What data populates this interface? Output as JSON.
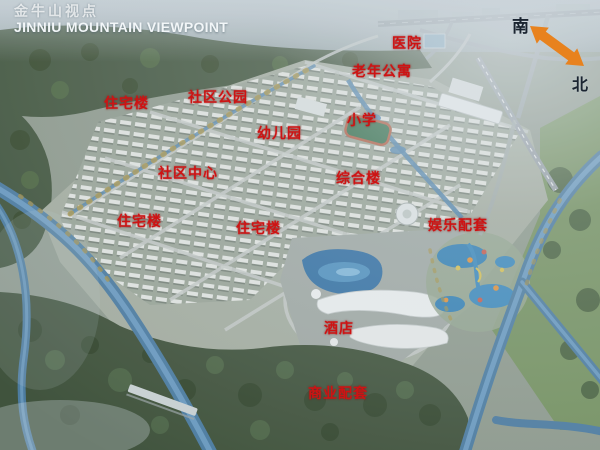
{
  "header": {
    "title_cn": "金牛山视点",
    "title_en": "JINNIU MOUNTAIN VIEWPOINT"
  },
  "compass": {
    "south_label": "南",
    "north_label": "北",
    "arrow_icon": "double-headed-diagonal-arrow"
  },
  "map_labels": [
    {
      "text": "医院"
    },
    {
      "text": "老年公寓"
    },
    {
      "text": "住宅楼"
    },
    {
      "text": "社区公园"
    },
    {
      "text": "幼儿园"
    },
    {
      "text": "小学"
    },
    {
      "text": "社区中心"
    },
    {
      "text": "综合楼"
    },
    {
      "text": "住宅楼"
    },
    {
      "text": "住宅楼"
    },
    {
      "text": "娱乐配套"
    },
    {
      "text": "酒店"
    },
    {
      "text": "商业配套"
    }
  ],
  "colors": {
    "label_red": "#CE1313",
    "compass_arrow_orange": "#E8821E",
    "title_white": "#F2F6F8",
    "water_blue": "#477AA6",
    "forest_green": "#3B4E35"
  }
}
